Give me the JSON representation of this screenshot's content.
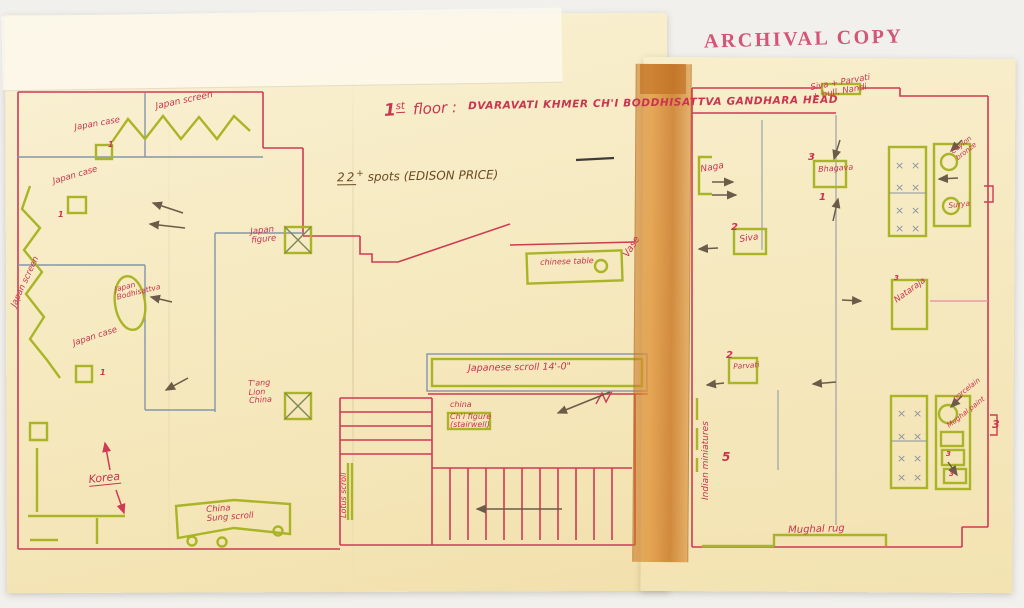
{
  "document": {
    "type_label": "ARCHIVAL COPY"
  },
  "title_block": {
    "number": "1",
    "ordinal": "st",
    "word": "floor :",
    "items": [
      "DVARAVATI",
      "KHMER",
      "CH'I BODDHISATTVA",
      "GANDHARA HEAD"
    ]
  },
  "lighting_note": {
    "count": "22",
    "plus": "+",
    "rest": " spots (EDISON PRICE)"
  },
  "left_gallery": {
    "japan_case_1": "Japan case",
    "japan_case_1_qty": "1",
    "japan_screen_top": "Japan screen",
    "japan_case_2": "Japan case",
    "japan_case_2_qty": "1",
    "japan_screen_side": "Japan screen",
    "japan_bodhisattva_line1": "Japan",
    "japan_bodhisattva_line2": "Bodhisattva",
    "japan_case_3": "Japan case",
    "japan_case_3_qty": "1",
    "korea": "Korea",
    "sung_scroll_line1": "China",
    "sung_scroll_line2": "Sung scroll"
  },
  "center_gallery": {
    "japan_figure_line1": "Japan",
    "japan_figure_line2": "figure",
    "tang_line1": "T'ang",
    "tang_line2": "Lion",
    "tang_line3": "China",
    "chinese_table": "chinese table",
    "vase": "Vase",
    "japanese_scroll": "Japanese scroll 14'-0\"",
    "chi_line1": "china",
    "chi_line2": "Ch'i figure",
    "chi_line3": "(stairwell)",
    "lotus_scroll": "Lotus scroll"
  },
  "right_gallery": {
    "wall_note_line1": "Siva + Parvati",
    "wall_note_line2": "+ bull, Nandi",
    "naga": "Naga",
    "bhagava": "Bhagava",
    "bhagava_qty": "3",
    "bhagava_note": "1",
    "siva": "Siva",
    "siva_qty": "2",
    "nataraja": "Nataraja",
    "nataraja_qty": "3",
    "parvati": "Parvati",
    "parvati_qty": "2",
    "indian_miniatures": "Indian miniatures",
    "room_count": "5",
    "mughal_rug": "Mughal rug",
    "case_ceylon_line1": "Ceylon",
    "case_ceylon_line2": "bronze",
    "case_surya": "Surya",
    "case_porcelain": "porcelain",
    "case_mughal_paint": "Mughal paint",
    "case_qty_a": "3",
    "case_qty_b": "3",
    "boxed_count": "3"
  },
  "colors": {
    "ink_red": "#cf3a55",
    "ink_green": "#a9b526",
    "pencil_blue": "#8495ab",
    "pencil_dark": "#6b5c49",
    "tape": "#d9913c",
    "stamp_red": "#cf4166",
    "paper": "#f6ebc4"
  }
}
